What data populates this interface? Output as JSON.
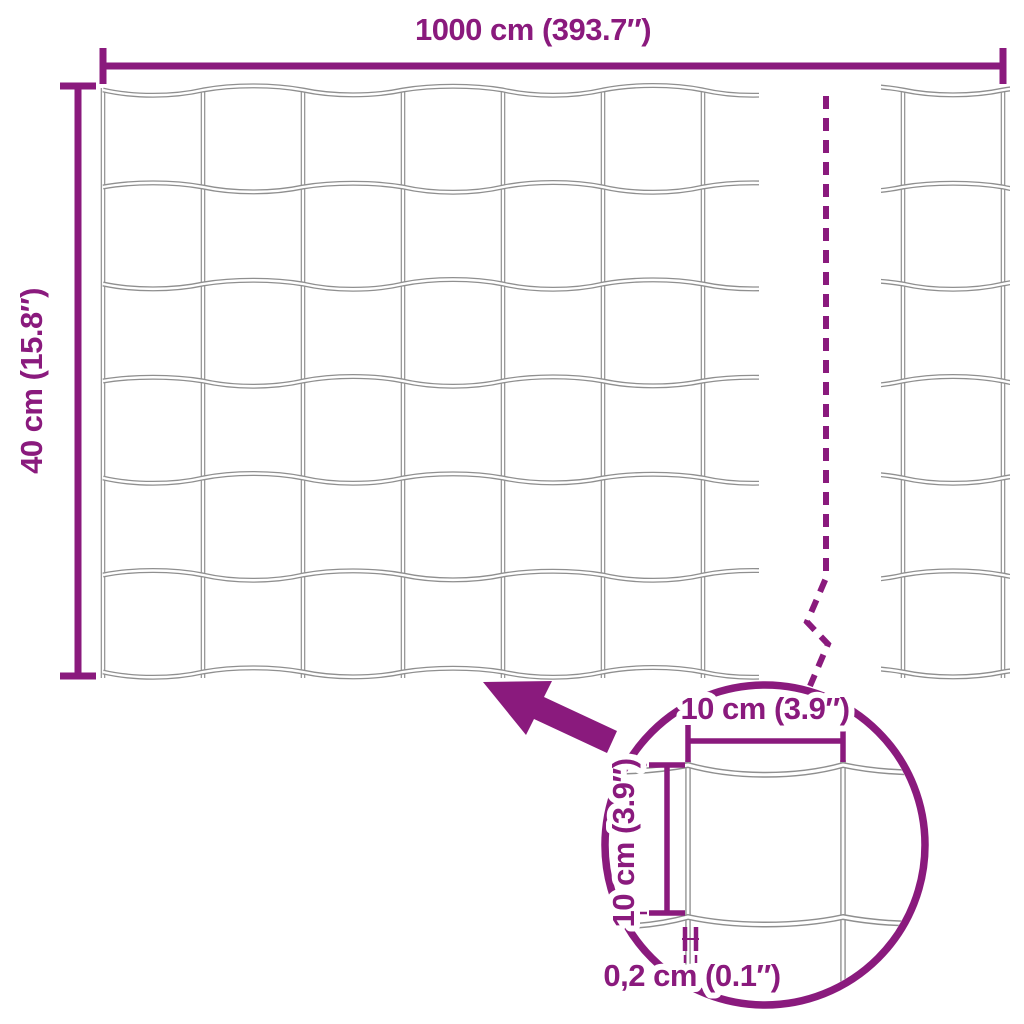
{
  "diagram": {
    "labels": {
      "total_width": "1000 cm (393.7″)",
      "total_height": "40 cm (15.8″)",
      "detail_mesh_width": "10 cm (3.9″)",
      "detail_mesh_height": "10 cm (3.9″)",
      "detail_wire_thickness": "0,2 cm (0.1″)"
    },
    "colors": {
      "accent": "#8A1A7D",
      "wire": "#8F8F8F",
      "background": "#FFFFFF"
    }
  }
}
